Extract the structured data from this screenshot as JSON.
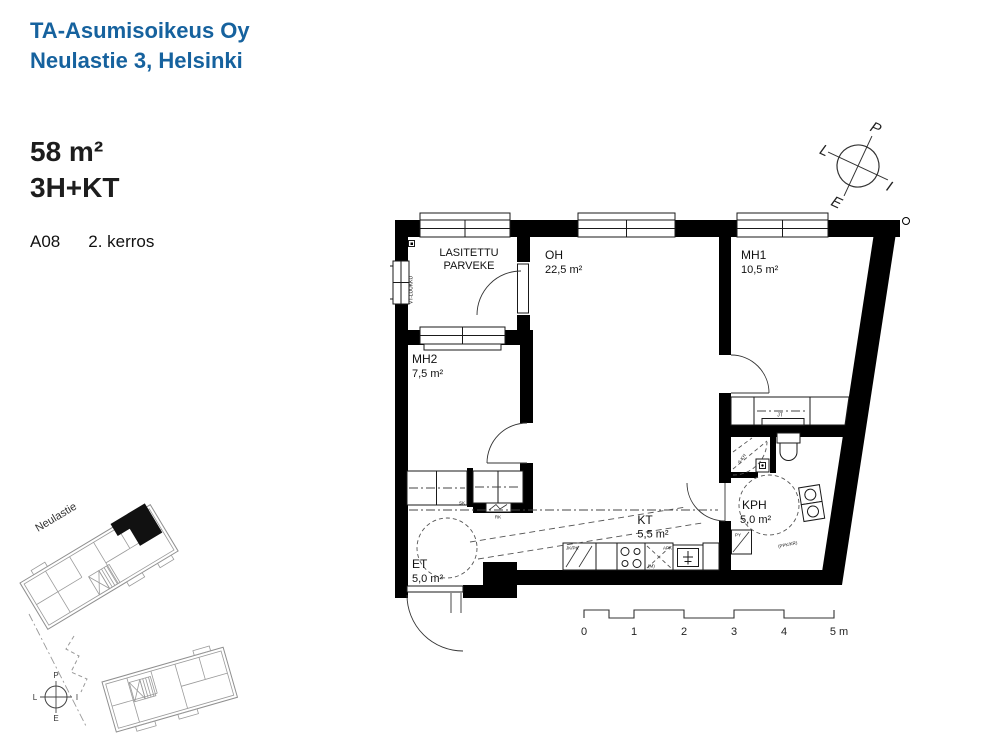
{
  "header": {
    "company": "TA-Asumisoikeus Oy",
    "address": "Neulastie 3, Helsinki",
    "accent_color": "#16629e"
  },
  "apartment": {
    "area": "58 m²",
    "type": "3H+KT",
    "code": "A08",
    "floor": "2. kerros"
  },
  "compass": {
    "north": "P",
    "east": "I",
    "south": "E",
    "west": "L"
  },
  "rooms": {
    "parveke": {
      "line1": "LASITETTU",
      "line2": "PARVEKE"
    },
    "oh": {
      "name": "OH",
      "area": "22,5 m²"
    },
    "mh1": {
      "name": "MH1",
      "area": "10,5 m²"
    },
    "mh2": {
      "name": "MH2",
      "area": "7,5 m²"
    },
    "kt": {
      "name": "KT",
      "area": "5,5 m²"
    },
    "kph": {
      "name": "KPH",
      "area": "5,0 m²"
    },
    "et": {
      "name": "ET",
      "area": "5,0 m²"
    }
  },
  "fixtures": {
    "vt_luukku": "VT-LUUKKU",
    "sk": "SK",
    "rk": "RK",
    "jt": "JT",
    "jk_pk": "JK/PK",
    "apk": "APK",
    "m": "(M)",
    "py": "PY",
    "ppk_kr": "(PPK/KR)",
    "shower": "S-KH"
  },
  "scalebar": {
    "ticks": [
      "0",
      "1",
      "2",
      "3",
      "4"
    ],
    "end": "5 m"
  },
  "siteplan": {
    "street": "Neulastie"
  },
  "colors": {
    "wall": "#000000",
    "plan_line": "#1a1a1a",
    "site_gray": "#8f8f8f"
  }
}
